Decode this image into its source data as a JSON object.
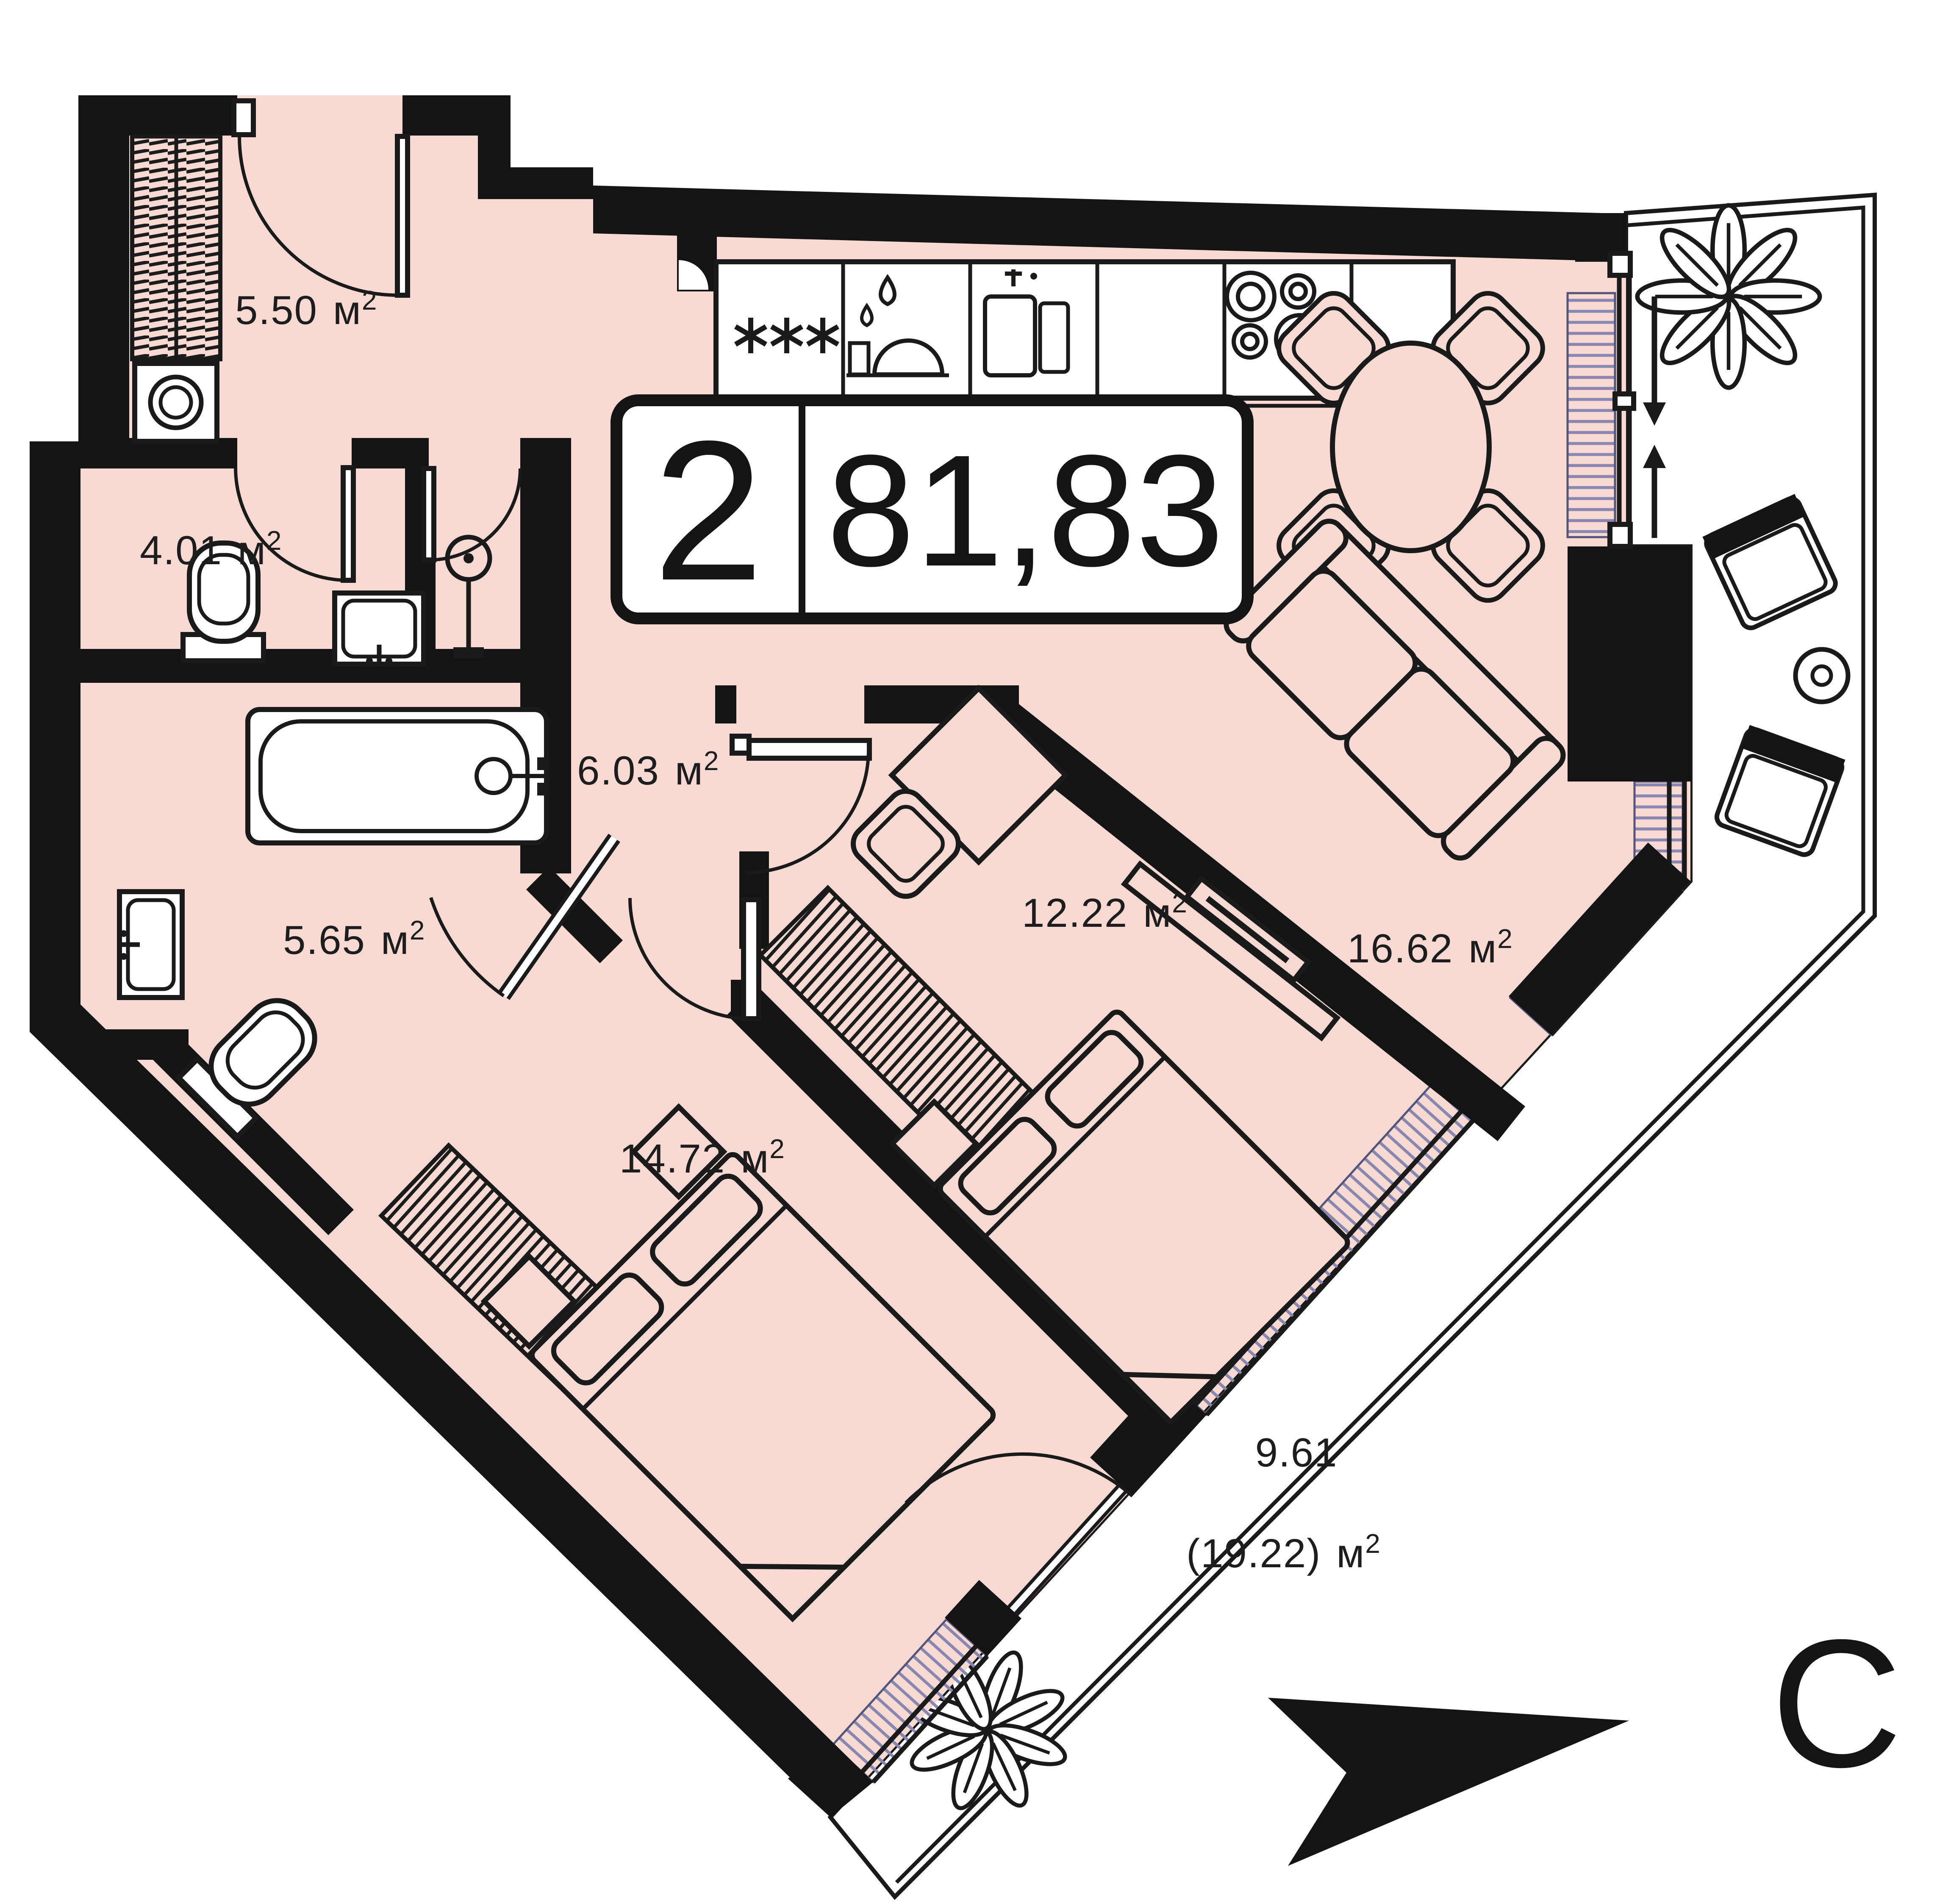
{
  "badge": {
    "rooms": "2",
    "area": "81,83"
  },
  "areas": {
    "entry_hall": "5.50",
    "wc": "4.01",
    "kitchen_living": "7.47",
    "hallway": "6.03",
    "bathroom": "5.65",
    "bedroom_main": "14.72",
    "bedroom_second": "12.22",
    "living_zone": "16.62",
    "balcony_reduced": "9.61",
    "balcony_full": "(19.22)"
  },
  "units": {
    "meter": "м",
    "sup": "2"
  },
  "compass": {
    "north": "С"
  },
  "colors": {
    "floor": "#f9d9d3",
    "walls": "#141414",
    "balcony_floor": "#ffffff",
    "sill_hatch": "#8787b0",
    "line": "#1a1a1a"
  }
}
